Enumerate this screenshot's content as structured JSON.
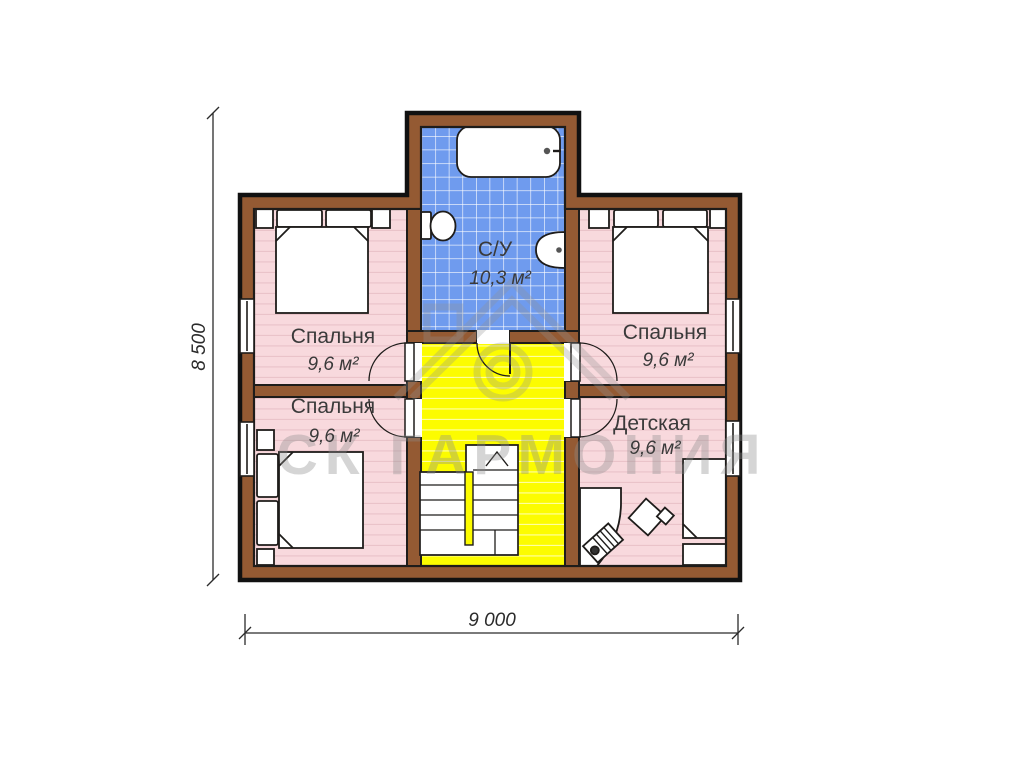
{
  "watermark": {
    "text": "СК ГАРМОНИЯ"
  },
  "dimensions": {
    "height": "8 500",
    "width": "9 000"
  },
  "rooms": {
    "bathroom": {
      "label": "С/У",
      "area": "10,3 м²"
    },
    "bedroom_top_left": {
      "label": "Спальня",
      "area": "9,6 м²"
    },
    "bedroom_top_right": {
      "label": "Спальня",
      "area": "9,6 м²"
    },
    "bedroom_bottom_left": {
      "label": "Спальня",
      "area": "9,6 м²"
    },
    "kids_room": {
      "label": "Детская",
      "area": "9,6 м²"
    }
  },
  "colors": {
    "wall": "#945a33",
    "outline": "#1e1c1a",
    "floor_pink": "#f8d9dd",
    "floor_pink_stripe": "#eac3c9",
    "floor_yellow": "#fcfc00",
    "floor_yellow_stripe": "#ffffa0",
    "floor_blue": "#6f9bee",
    "tile_grid": "#ffffff",
    "watermark_gray": "#8c8c8c"
  }
}
